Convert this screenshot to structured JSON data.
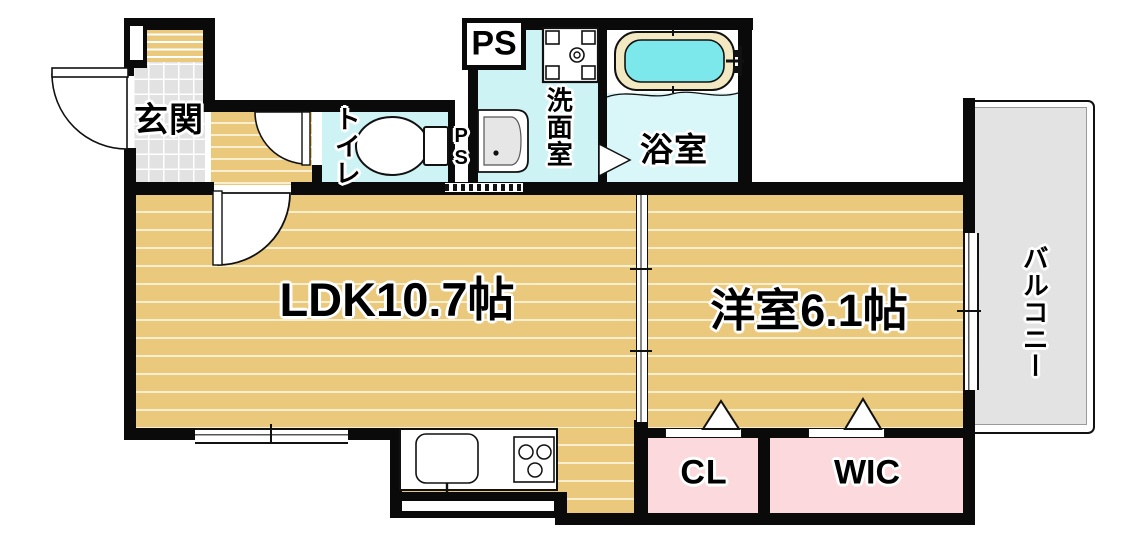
{
  "floorplan": {
    "labels": {
      "entrance": "玄関",
      "toilet": "トイレ",
      "pipe_space_top": "PS",
      "pipe_space_side": "PS",
      "washroom": "洗面室",
      "bathroom": "浴室",
      "ldk": "LDK10.7帖",
      "western_room": "洋室6.1帖",
      "balcony": "バルコニー",
      "closet": "CL",
      "walk_in_closet": "WIC"
    },
    "colors": {
      "wall": "#0a0a0a",
      "wood": "#eac87c",
      "wood-stripe": "#f9efcf",
      "tile": "#e2e2e2",
      "wet": "#cdf3f5",
      "bath-floor": "#d9f6f8",
      "tub-water": "#7ce8ec",
      "tub-rim": "#f2e9c3",
      "closet": "#fbd9dc",
      "balcony": "#e3e3e3"
    }
  }
}
